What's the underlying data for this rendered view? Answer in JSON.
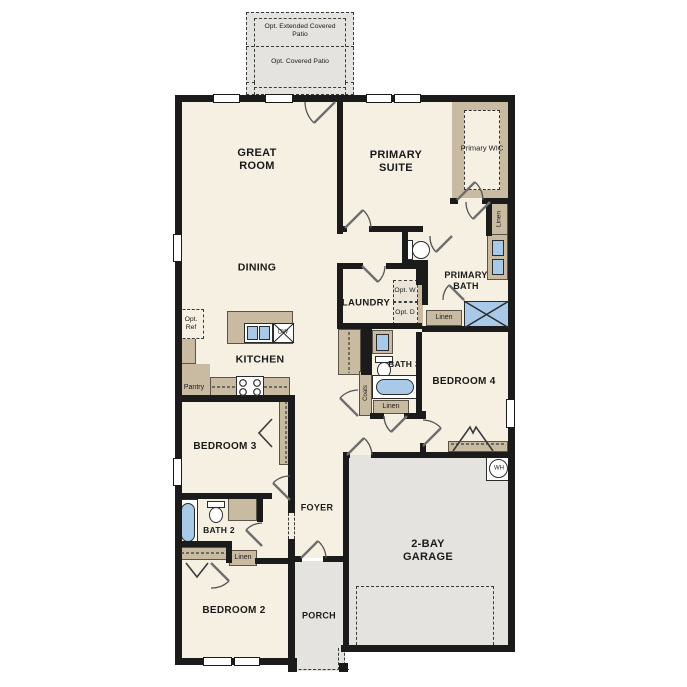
{
  "rooms": {
    "great_room": "GREAT ROOM",
    "dining": "DINING",
    "kitchen": "KITCHEN",
    "primary_suite": "PRIMARY SUITE",
    "primary_wic": "Primary WIC",
    "primary_bath": "PRIMARY BATH",
    "laundry": "LAUNDRY",
    "bath_3": "BATH 3",
    "bedroom_4": "BEDROOM 4",
    "bedroom_3": "BEDROOM 3",
    "foyer": "FOYER",
    "bath_2": "BATH 2",
    "bedroom_2": "BEDROOM 2",
    "porch": "PORCH",
    "garage": "2-BAY GARAGE"
  },
  "options": {
    "extended_patio": "Opt. Extended Covered Patio",
    "covered_patio": "Opt. Covered Patio",
    "refrigerator": "Opt. Ref",
    "washer": "Opt. W",
    "dryer": "Opt. D"
  },
  "storage": {
    "linen_primary_wic": "Linen",
    "linen_primary_bath": "Linen",
    "linen_bath_3": "Linen",
    "linen_bath_2": "Linen",
    "coats": "Coats",
    "pantry": "Pantry"
  },
  "appliances": {
    "dishwasher": "DW",
    "water_heater": "WH"
  },
  "colors": {
    "wall": "#1b1b1b",
    "floor": "#f6f0e3",
    "cabinetry": "#c9bba2",
    "fixture_blue": "#a9c9e9",
    "exterior_gray": "#e4e3df"
  }
}
